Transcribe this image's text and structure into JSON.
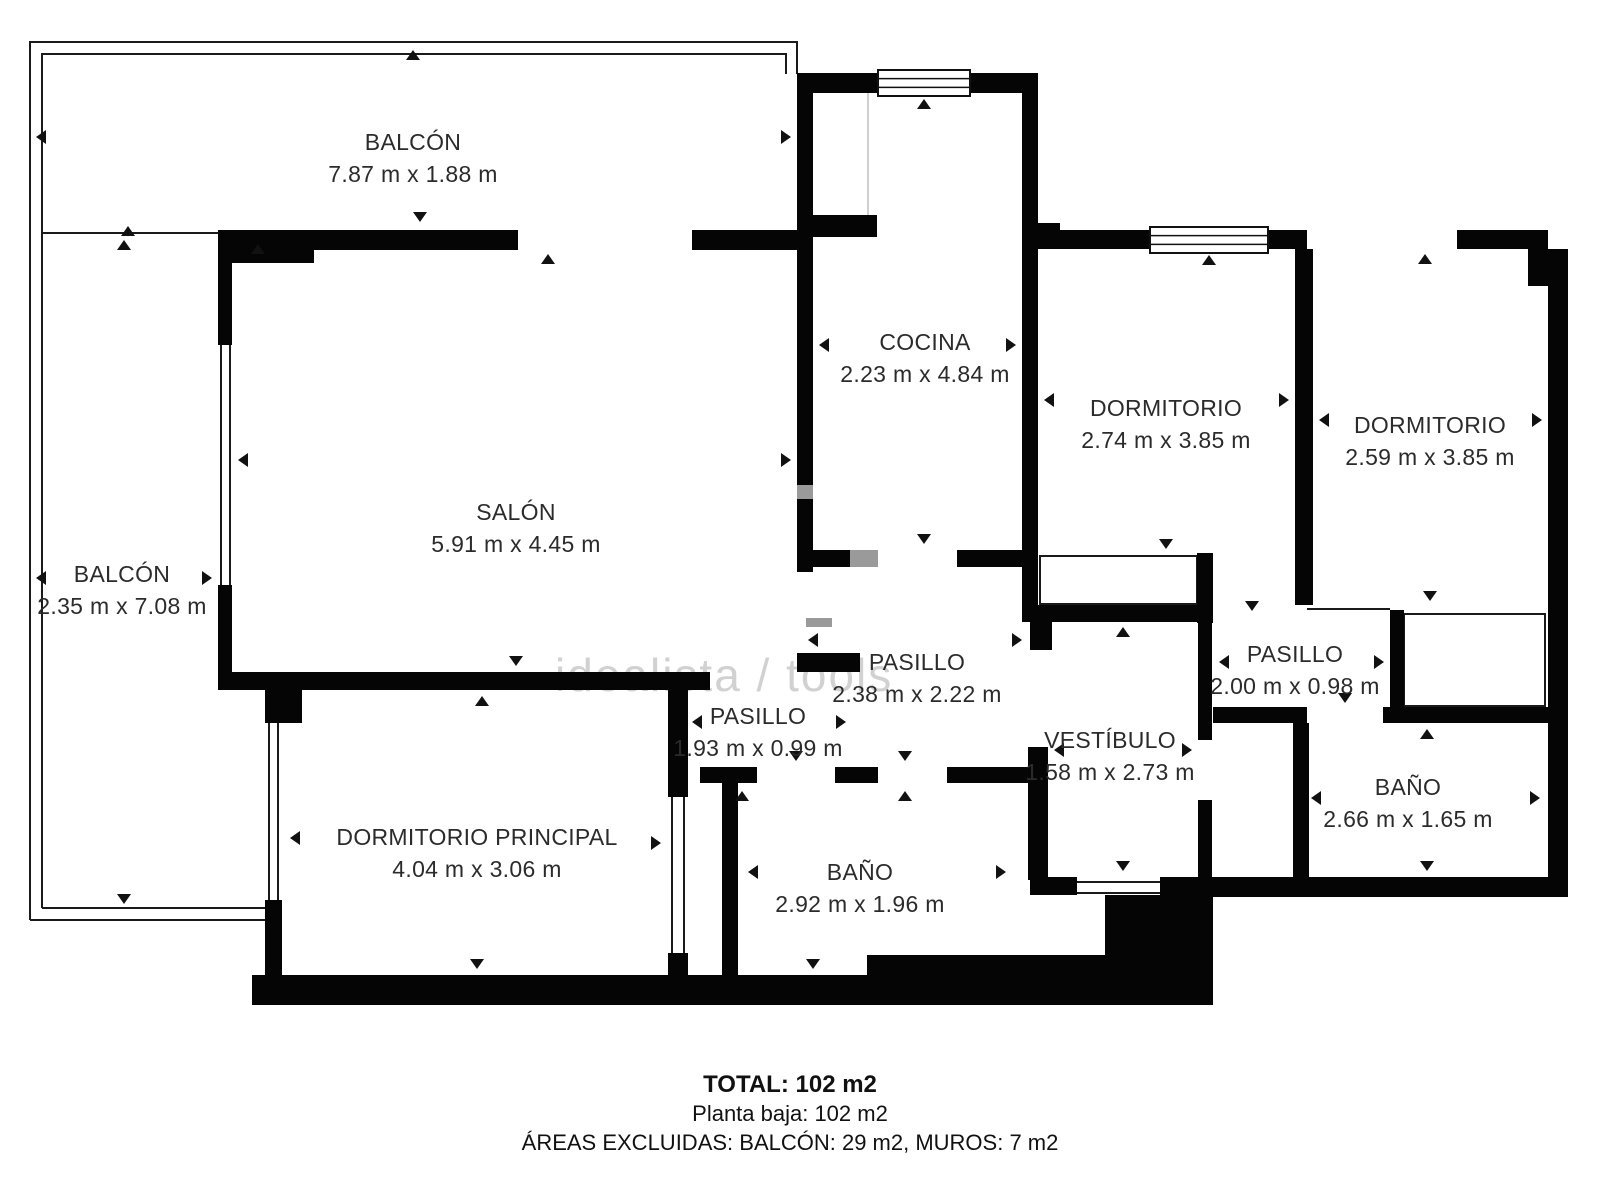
{
  "watermark": "idealista / tools",
  "rooms": {
    "balcon_top": {
      "name": "BALCÓN",
      "dims": "7.87 m x 1.88 m"
    },
    "balcon_left": {
      "name": "BALCÓN",
      "dims": "2.35 m x 7.08 m"
    },
    "salon": {
      "name": "SALÓN",
      "dims": "5.91 m x 4.45 m"
    },
    "cocina": {
      "name": "COCINA",
      "dims": "2.23 m x 4.84 m"
    },
    "dormitorio_1": {
      "name": "DORMITORIO",
      "dims": "2.74 m x 3.85 m"
    },
    "dormitorio_2": {
      "name": "DORMITORIO",
      "dims": "2.59 m x 3.85 m"
    },
    "pasillo_central": {
      "name": "PASILLO",
      "dims": "2.38 m x 2.22 m"
    },
    "pasillo_izquierdo": {
      "name": "PASILLO",
      "dims": "1.93 m x 0.99 m"
    },
    "pasillo_derecho": {
      "name": "PASILLO",
      "dims": "2.00 m x 0.98 m"
    },
    "vestibulo": {
      "name": "VESTÍBULO",
      "dims": "1.58 m x 2.73 m"
    },
    "bano_derecho": {
      "name": "BAÑO",
      "dims": "2.66 m x 1.65 m"
    },
    "bano_central": {
      "name": "BAÑO",
      "dims": "2.92 m x 1.96 m"
    },
    "dormitorio_principal": {
      "name": "DORMITORIO PRINCIPAL",
      "dims": "4.04 m x 3.06 m"
    }
  },
  "footer": {
    "total": "TOTAL: 102 m2",
    "floor": "Planta baja: 102 m2",
    "excluded": "ÁREAS EXCLUIDAS: BALCÓN: 29 m2, MUROS: 7 m2"
  }
}
